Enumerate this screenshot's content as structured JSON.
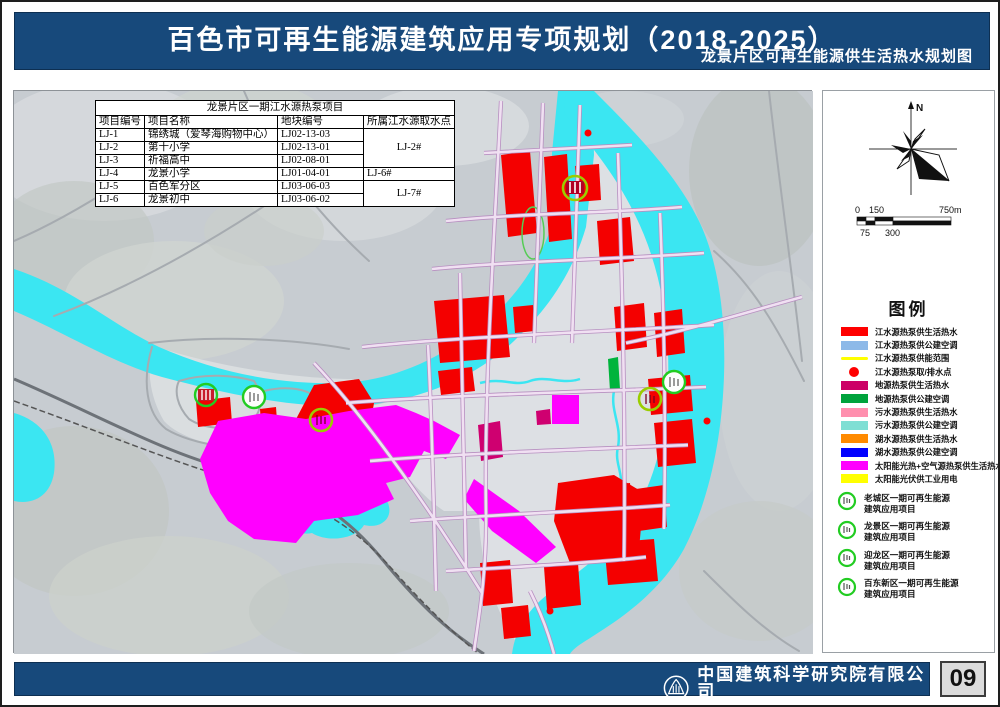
{
  "page": {
    "number": "09"
  },
  "header": {
    "title": "百色市可再生能源建筑应用专项规划（2018-2025）",
    "subtitle": "龙景片区可再生能源供生活热水规划图"
  },
  "map": {
    "table": {
      "title": "龙景片区一期江水源热泵项目",
      "headers": [
        "项目编号",
        "项目名称",
        "地块编号",
        "所属江水源取水点"
      ],
      "rows": [
        [
          "LJ-1",
          "锦绣城（爱琴海购物中心）",
          "LJ02-13-03"
        ],
        [
          "LJ-2",
          "第十小学",
          "LJ02-13-01"
        ],
        [
          "LJ-3",
          "祈福高中",
          "LJ02-08-01"
        ],
        [
          "LJ-4",
          "龙景小学",
          "LJ01-04-01"
        ],
        [
          "LJ-5",
          "百色军分区",
          "LJ03-06-03"
        ],
        [
          "LJ-6",
          "龙景初中",
          "LJ03-06-02"
        ]
      ],
      "intake_points": [
        "LJ-2#",
        "LJ-6#",
        "LJ-7#"
      ]
    }
  },
  "panel": {
    "compass_label": "N",
    "scale": {
      "labels_top": [
        "0",
        "150",
        "750m"
      ],
      "labels_bottom": [
        "75",
        "300"
      ]
    },
    "legend": {
      "title": "图例",
      "items": [
        {
          "swatch": "rect",
          "color": "#FF0000",
          "label": "江水源热泵供生活热水"
        },
        {
          "swatch": "rect",
          "color": "#8DB9E8",
          "label": "江水源热泵供公建空调"
        },
        {
          "swatch": "line",
          "color": "#FFFF00",
          "label": "江水源热泵供能范围"
        },
        {
          "swatch": "dot",
          "color": "#FF0000",
          "label": "江水源热泵取/排水点"
        },
        {
          "swatch": "rect",
          "color": "#CC0066",
          "label": "地源热泵供生活热水"
        },
        {
          "swatch": "rect",
          "color": "#00A33C",
          "label": "地源热泵供公建空调"
        },
        {
          "swatch": "rect",
          "color": "#FF8FAE",
          "label": "污水源热泵供生活热水"
        },
        {
          "swatch": "rect",
          "color": "#7FDFD4",
          "label": "污水源热泵供公建空调"
        },
        {
          "swatch": "rect",
          "color": "#FF8A00",
          "label": "湖水源热泵供生活热水"
        },
        {
          "swatch": "rect",
          "color": "#0000FF",
          "label": "湖水源热泵供公建空调"
        },
        {
          "swatch": "rect",
          "color": "#FF00FF",
          "label": "太阳能光热+空气源热泵供生活热水"
        },
        {
          "swatch": "rect",
          "color": "#FFFF00",
          "label": "太阳能光伏供工业用电"
        }
      ],
      "projects": [
        {
          "line1": "老城区一期可再生能源",
          "line2": "建筑应用项目"
        },
        {
          "line1": "龙景区一期可再生能源",
          "line2": "建筑应用项目"
        },
        {
          "line1": "迎龙区一期可再生能源",
          "line2": "建筑应用项目"
        },
        {
          "line1": "百东新区一期可再生能源",
          "line2": "建筑应用项目"
        }
      ]
    }
  },
  "footer": {
    "company_cn": "中国建筑科学研究院有限公司",
    "company_en": "China Academy of Building Research"
  },
  "colors": {
    "band_blue": "#17497B",
    "river_cyan": "#3BE6F2",
    "zone_red": "#F40000",
    "zone_magenta": "#FF00FF",
    "zone_crimson": "#CF0070",
    "marker_ring_green": "#22CC22",
    "marker_ring_olive": "#9ACD00"
  }
}
